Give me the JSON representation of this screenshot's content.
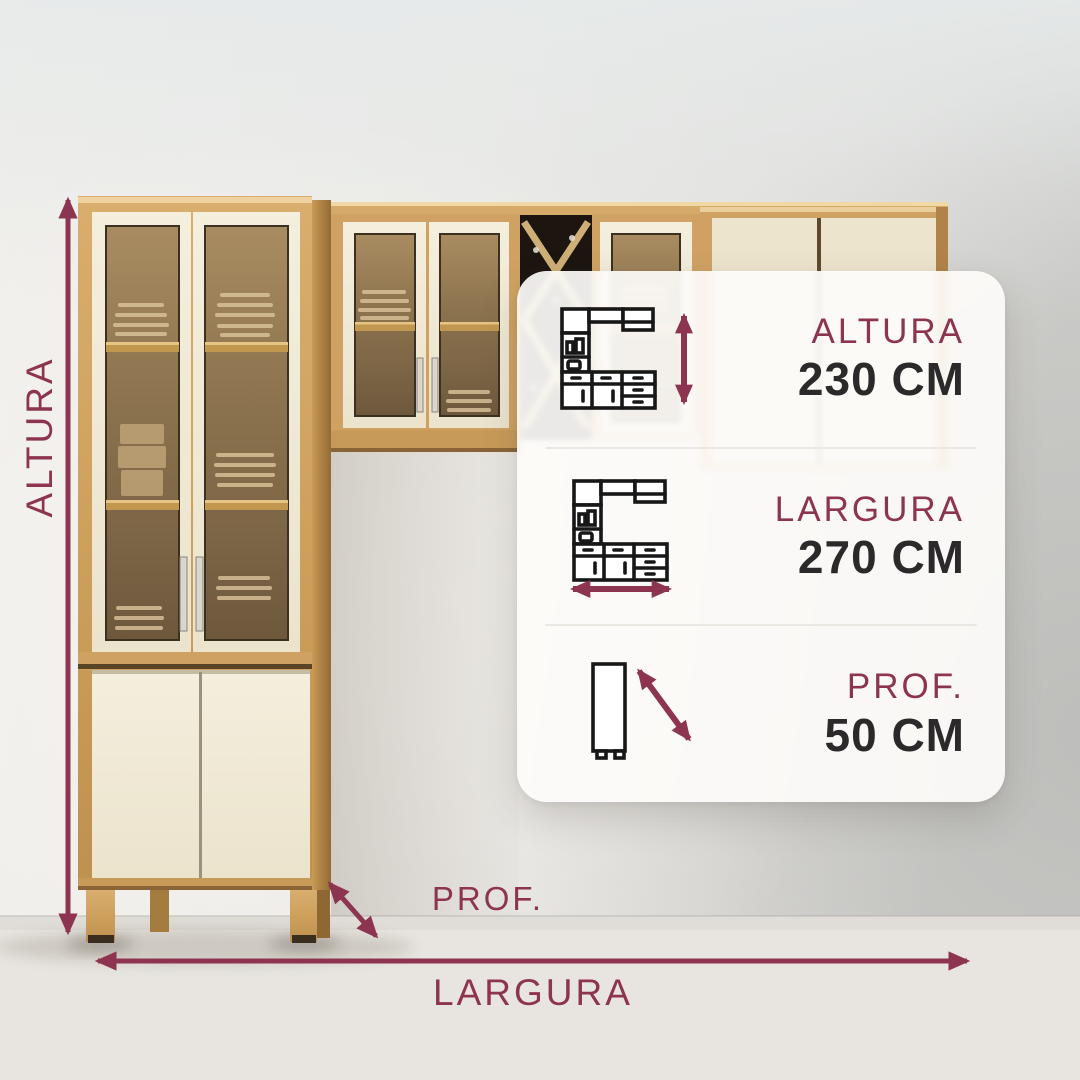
{
  "dimension_overlay": {
    "altura_label": "ALTURA",
    "largura_label": "LARGURA",
    "prof_label": "PROF."
  },
  "card": {
    "rows": [
      {
        "icon": "kitchen-cabinet-height-icon",
        "label": "ALTURA",
        "value": "230 CM"
      },
      {
        "icon": "kitchen-cabinet-width-icon",
        "label": "LARGURA",
        "value": "270 CM"
      },
      {
        "icon": "cabinet-side-depth-icon",
        "label": "PROF.",
        "value": "50 CM"
      }
    ]
  },
  "colors": {
    "accent_maroon": "#8d3550",
    "value_text": "#2b292a",
    "card_background": "rgba(253,252,250,0.92)",
    "wood": "#cfa263",
    "cream_door": "#f2ecda"
  }
}
